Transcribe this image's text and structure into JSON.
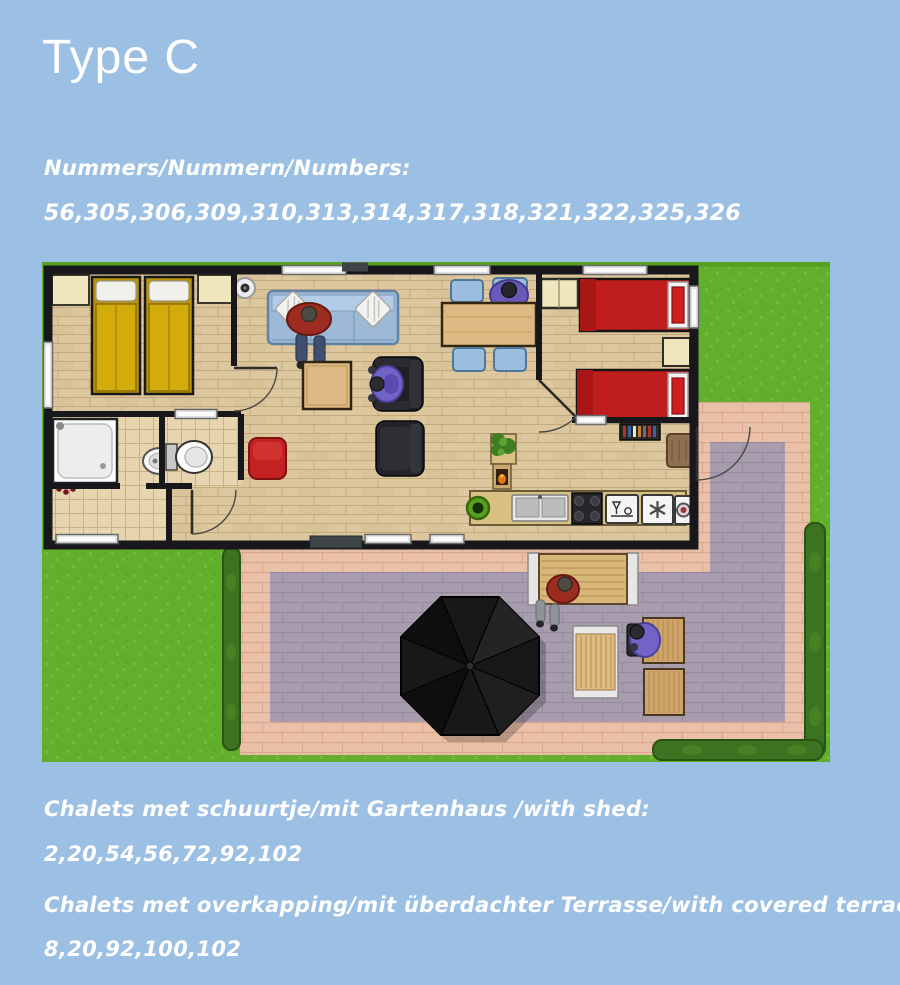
{
  "title": "Type C",
  "sections": {
    "numbers": {
      "label": "Nummers/Nummern/Numbers:",
      "values": "56,305,306,309,310,313,314,317,318,321,322,325,326"
    },
    "shed": {
      "label": "Chalets met schuurtje/mit Gartenhaus /with shed:",
      "values": "2,20,54,56,72,92,102"
    },
    "covered_terrace": {
      "label": "Chalets met overkapping/mit überdachter Terrasse/with covered terrace:",
      "values": "8,20,92,100,102"
    }
  },
  "floorplan": {
    "alt": "Top-down floor plan of chalet Type C: bedroom with two yellow beds, bathroom with shower and washbasin, separate toilet, tiled hall, open living room with blue sofa and black armchairs, dining table with blue chairs, kitchen row with sink, stove, dishwasher, freezer and washer, bedroom with two red beds, paved terrace with black parasol, garden table, lounger and hedges around the lawn"
  },
  "colors": {
    "bg": "#9cc0e4",
    "text": "#ffffff",
    "grass": "#61af2b",
    "grass-light": "#70bd37",
    "hedge": "#3c7320",
    "hedge-dark": "#2a5414",
    "pink": "#eac0a8",
    "pink-line": "#d8a88e",
    "purple": "#a89dae",
    "purple-line": "#968a9e",
    "wood": "#dcc79f",
    "wood-line": "#c4a97c",
    "tile": "#e6d5ae",
    "tile-line": "#c9b184",
    "wall": "#17171c",
    "bed-yellow": "#d3ac0b",
    "bed-red": "#c01d1d",
    "sofa-blue": "#9db9d6",
    "chair-blue": "#9cbede",
    "table-wood": "#ddba84",
    "cream": "#efe6bd",
    "parasol": "#181818",
    "pouf": "#c32222",
    "person-red": "#9c2c20",
    "person-purple": "#7263c6"
  }
}
